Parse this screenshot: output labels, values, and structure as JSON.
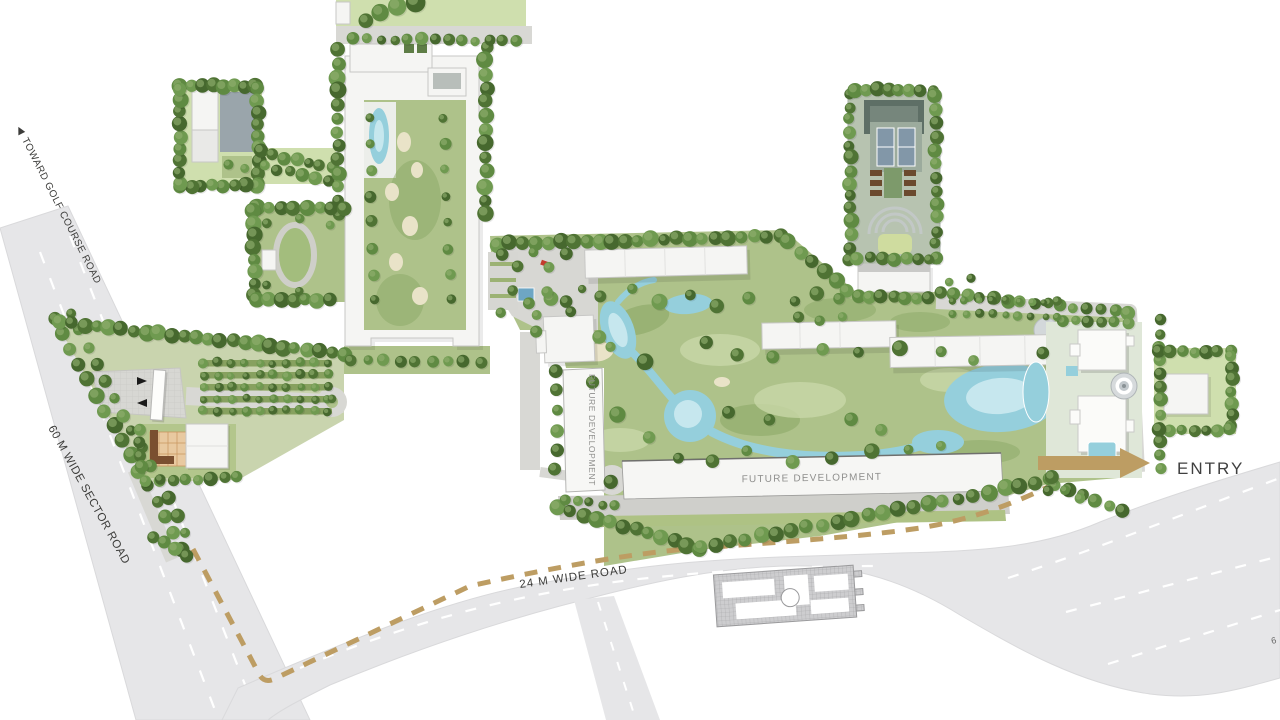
{
  "title": "Residential Township Master Plan",
  "labels": {
    "toward_golf_arrow": "◀",
    "toward_golf": "TOWARD GOLF COURSE ROAD",
    "sector_road": "60 M WIDE SECTOR ROAD",
    "wide_road": "24 M WIDE ROAD",
    "future_dev_vertical": "FUTURE DEVELOPMENT",
    "future_dev_main": "FUTURE DEVELOPMENT",
    "entry": "ENTRY",
    "road_label_cut": "6"
  },
  "palette": {
    "bg": "#ffffff",
    "road": "#e6e6e8",
    "roadEdge": "#d9d9db",
    "laneLine": "#ffffff",
    "lawn": "#aec28a",
    "lawnDark": "#8aa765",
    "lawnLight": "#c8d7a8",
    "paleLawn": "#cfdfae",
    "paving": "#d7d7d3",
    "water": "#95cfdc",
    "waterLight": "#c6e7ee",
    "building": "#f5f5f3",
    "buildingStroke": "#c7c7c5",
    "shadow": "#00000022",
    "treeDark": "#46682e",
    "treeMid1": "#4f7334",
    "treeMid2": "#5f8a42",
    "treeLight": "#6f9a50",
    "treeHighlight": "#8fae6d",
    "tan": "#bd9d63",
    "brown": "#6b4a2e",
    "sand": "#e9e3c8",
    "court": "#8297a8",
    "darkRoof": "#5e6f66",
    "hatchBase": "#cdcdcf",
    "hatchLine": "#a8a8aa",
    "labelDark": "#3c3c3a",
    "labelSoft": "#8f8f8d"
  }
}
